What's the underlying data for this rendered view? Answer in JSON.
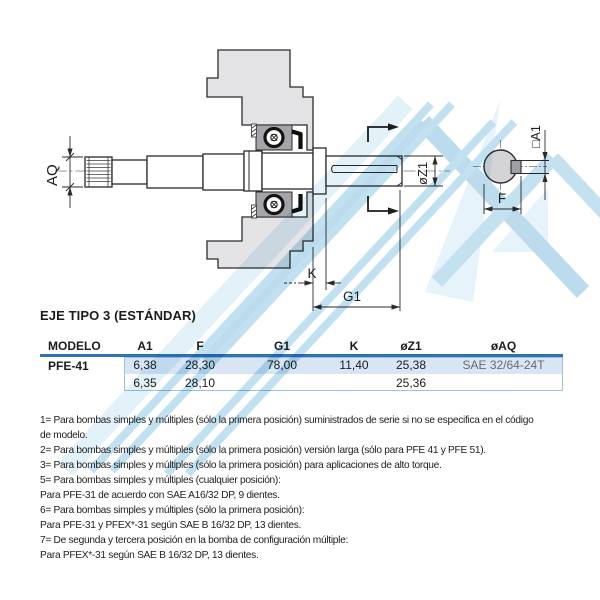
{
  "page": {
    "background": "#ffffff"
  },
  "drawing": {
    "labels": {
      "aq": "AQ",
      "dz1": "øZ1",
      "sqa1": "□A1",
      "f": "F",
      "k": "K",
      "g1": "G1"
    }
  },
  "section": {
    "title": "EJE TIPO 3 (ESTÁNDAR)"
  },
  "table": {
    "accent_color": "#2e74b5",
    "highlight_color": "#d8e6f4",
    "border_color": "#9cc2dc",
    "headers": [
      "MODELO",
      "A1",
      "F",
      "G1",
      "K",
      "øZ1",
      "øAQ"
    ],
    "rows": [
      {
        "modelo": "PFE-41",
        "a1": "6,38",
        "f": "28,30",
        "g1": "78,00",
        "k": "11,40",
        "z1": "25,38",
        "aq": "SAE 32/64-24T"
      },
      {
        "modelo": "",
        "a1": "6,35",
        "f": "28,10",
        "g1": "",
        "k": "",
        "z1": "25,36",
        "aq": ""
      }
    ]
  },
  "notes": {
    "lines": [
      "1= Para bombas simples y múltiples (sólo la primera posición) suministrados de serie si no se especifica en el código",
      "de modelo.",
      "2= Para bombas simples y múltiples (sólo la primera posición) versión larga (sólo para PFE 41 y PFE 51).",
      "3= Para bombas simples y múltiples (sólo la primera posición) para aplicaciones de alto torque.",
      "5= Para bombas simples y múltiples (cualquier posición):",
      "Para PFE-31 de acuerdo con SAE A16/32 DP, 9 dientes.",
      "6= Para bombas simples y múltiples (sólo la primera posición):",
      "Para PFE-31 y PFEX*-31 según SAE B 16/32 DP, 13 dientes.",
      "7= De segunda y tercera posición en la bomba de configuración múltiple:",
      "Para PFEX*-31 según SAE B 16/32 DP, 13 dientes."
    ]
  }
}
